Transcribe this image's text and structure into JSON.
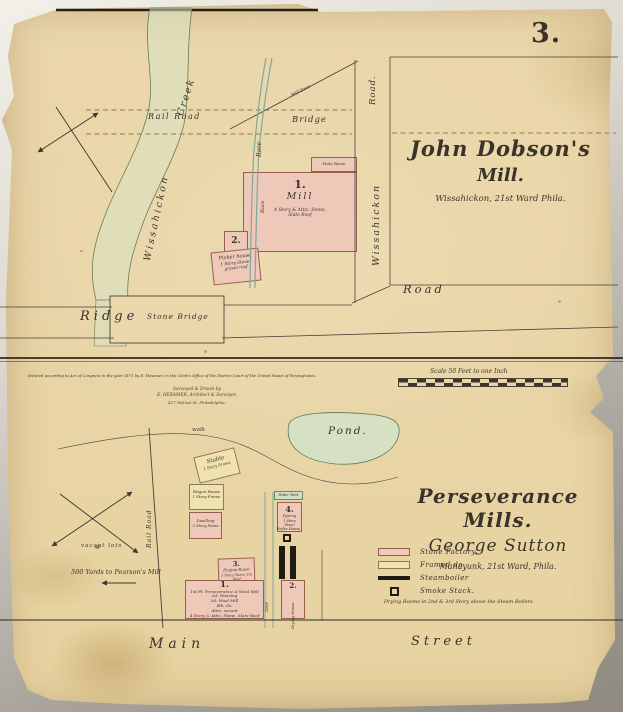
{
  "page": {
    "number": "3."
  },
  "colors": {
    "paper": "#ead7ab",
    "ink": "#3a332a",
    "stone_pink": "#eec9b9",
    "framed_cream": "#f0e2ae",
    "water_green": "#cfe0c6",
    "race_teal": "#7fa89d",
    "boiler_black": "#1e1b17",
    "rail_dash": "#907a50"
  },
  "top_map": {
    "title_line1": "John Dobson's",
    "title_line2": "Mill.",
    "subtitle": "Wissahickon, 21st Ward Phila.",
    "labels": {
      "creek": "Creek",
      "rail_road": "Rail Road",
      "bridge": "Bridge",
      "road_vertical": "Road.",
      "wissahickon_road": "Wissahickon",
      "wissahickon_creek": "Wissahickon",
      "race_upper": "Race",
      "race_mill": "Race",
      "mill_dam": "Mill Dam",
      "ridge": "Ridge",
      "stone_bridge": "Stone Bridge",
      "road_lower": "Road"
    },
    "buildings": {
      "mill_number": "1.",
      "mill_name": "Mill",
      "mill_desc_line1": "4 Story & Attic, Stone,",
      "mill_desc_line2": "Slate Roof",
      "annex_label": "Mule Room",
      "building2_number": "2.",
      "picker_line1": "Picker house",
      "picker_line2": "1 Story Stone,",
      "picker_line3": "gravel roof"
    }
  },
  "divider": {
    "copyright": "Entered according to Act of Congress in the year 1871 by E. Hexamer, in the Clerk's Office of the District Court of the United States of Pennsylvania.",
    "surveyor_line1": "Surveyed & Drawn by",
    "surveyor_line2": "E. HEXAMER, Architect & Surveyor,",
    "surveyor_line3": "427 Walnut St. Philadelphia.",
    "scale_label": "Scale 50 Feet to one Inch"
  },
  "bottom_map": {
    "title_line1": "Perseverance Mills.",
    "title_line2": "George Sutton",
    "subtitle": "Manayunk, 21st Ward, Phila.",
    "labels": {
      "pond": "Pond.",
      "walk": "walk",
      "rail_road": "Rail Road",
      "vacant_lots": "vacant lots",
      "distance_note": "500 Yards to Pearson's Mill",
      "race": "race",
      "main": "Main",
      "street": "Street"
    },
    "buildings": {
      "stable_line1": "Stable",
      "stable_line2": "1 Story Frame",
      "wagon_line1": "Wagon House",
      "wagon_line2": "1 Story Frame",
      "dwelling_line1": "Dwelling",
      "dwelling_line2": "2 Story Stone",
      "water_tank": "Water Tank",
      "dye_number": "4.",
      "dye_line1": "Dyeing",
      "dye_line2": "1 Story Stone",
      "boiler_house": "Boiler House",
      "engine_number": "3.",
      "engine_line1": "Engine Room",
      "engine_line2": "1 Story Stone, Tin Roof",
      "mill_number": "1.",
      "mill_line1": "1st Fl: Perseverance & Wool Mill",
      "mill_line2": "2d: Weaving",
      "mill_line3": "3d: Wool Mill",
      "mill_line4": "4th: do.",
      "mill_line5": "Attic: vacant",
      "mill_line6": "4 Story & Attic, Stone, Slate Roof",
      "drying_number": "2.",
      "drying_label": "Drying House"
    },
    "legend": [
      {
        "label": "Stone Factory"
      },
      {
        "label": "Framed  do."
      },
      {
        "label": "Steamboiler"
      },
      {
        "label": "Smoke Stack."
      }
    ],
    "note": "Drying Rooms in 2nd & 3rd Story above the Steam Boilers."
  }
}
